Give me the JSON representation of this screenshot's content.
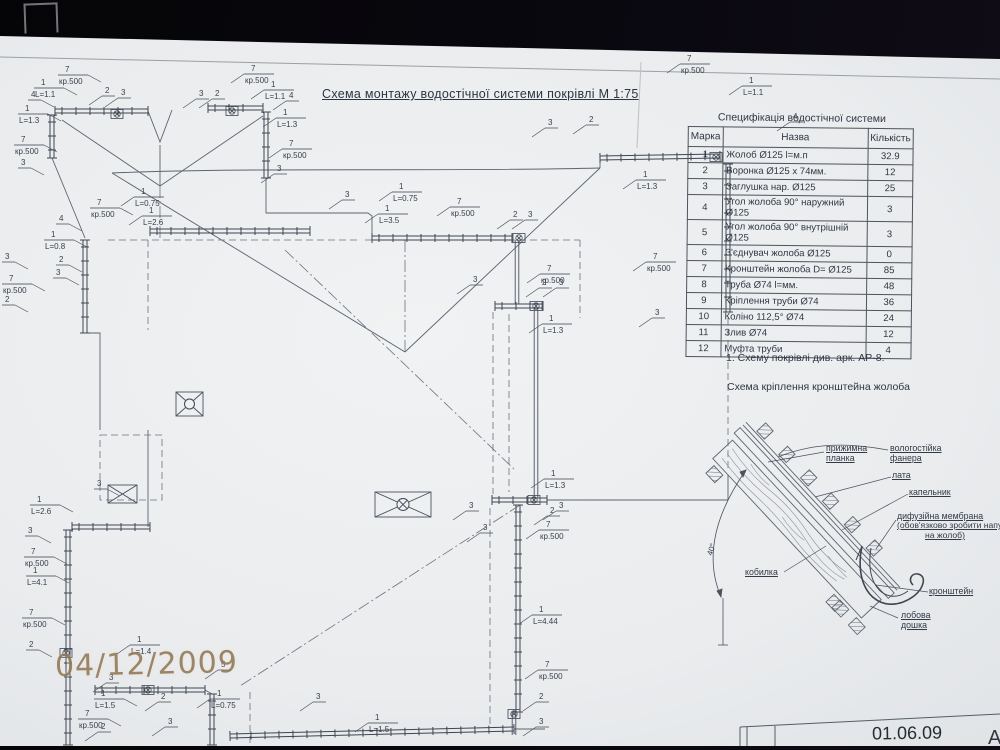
{
  "main_title": "Схема монтажу водостічної системи покрівлі М 1:75",
  "spec_table": {
    "title": "Специфікація водостічної системи",
    "columns": [
      "Марка",
      "Назва",
      "Кількість"
    ],
    "rows": [
      [
        "1",
        "Жолоб Ø125  l=м.п",
        "32.9"
      ],
      [
        "2",
        "Воронка Ø125 х 74мм.",
        "12"
      ],
      [
        "3",
        "Заглушка нар. Ø125",
        "25"
      ],
      [
        "4",
        "Угол жолоба 90° наружний  Ø125",
        "3"
      ],
      [
        "5",
        "Угол жолоба 90° внутрішній  Ø125",
        "3"
      ],
      [
        "6",
        "З'єднувач жолоба  Ø125",
        "0"
      ],
      [
        "7",
        "Кронштейн жолоба  D=  Ø125",
        "85"
      ],
      [
        "8",
        "Труба  Ø74  l=мм.",
        "48"
      ],
      [
        "9",
        "Кріплення труби  Ø74",
        "36"
      ],
      [
        "10",
        "Коліно 112,5°  Ø74",
        "24"
      ],
      [
        "11",
        "Злив  Ø74",
        "12"
      ],
      [
        "12",
        "Муфта труби",
        "4"
      ]
    ]
  },
  "note": "1.    Схему  покрівлі див. арк. АР-8.",
  "detail": {
    "title": "Схема кріплення кронштейна жолоба",
    "labels": {
      "plank": "прижимна планка",
      "plywood": "вологостійка фанера",
      "batten": "лата",
      "drip": "капельник",
      "membrane": "дифузійна мембрана",
      "membrane_note_1": "(обов'язково зробити напуск",
      "membrane_note_2": "на жолоб)",
      "bracket": "кронштейн",
      "fascia": "лобова дошка",
      "rafter": "кобилка",
      "angle": "40°"
    }
  },
  "plan": {
    "callouts": [
      [
        58,
        73,
        "7",
        "кр.500"
      ],
      [
        34,
        86,
        "1",
        "L=1.1"
      ],
      [
        28,
        98,
        "4",
        ""
      ],
      [
        18,
        112,
        "1",
        "L=1.3"
      ],
      [
        102,
        94,
        "2",
        ""
      ],
      [
        118,
        96,
        "3",
        ""
      ],
      [
        196,
        97,
        "3",
        ""
      ],
      [
        212,
        97,
        "2",
        ""
      ],
      [
        244,
        72,
        "7",
        "кр.500"
      ],
      [
        264,
        88,
        "1",
        "L=1.1"
      ],
      [
        286,
        99,
        "4",
        ""
      ],
      [
        276,
        116,
        "1",
        "L=1.3"
      ],
      [
        14,
        143,
        "7",
        "кр.500"
      ],
      [
        18,
        166,
        "3",
        ""
      ],
      [
        282,
        147,
        "7",
        "кр.500"
      ],
      [
        274,
        172,
        "3",
        ""
      ],
      [
        545,
        126,
        "3",
        ""
      ],
      [
        586,
        123,
        "2",
        ""
      ],
      [
        680,
        62,
        "7",
        "кр.500"
      ],
      [
        742,
        84,
        "1",
        "L=1.1"
      ],
      [
        790,
        120,
        "4",
        ""
      ],
      [
        636,
        178,
        "1",
        "L=1.3"
      ],
      [
        646,
        260,
        "7",
        "кр.500"
      ],
      [
        652,
        316,
        "3",
        ""
      ],
      [
        134,
        195,
        "1",
        "L=0.75"
      ],
      [
        142,
        214,
        "1",
        "L=2.6"
      ],
      [
        90,
        206,
        "7",
        "кр.500"
      ],
      [
        56,
        222,
        "4",
        ""
      ],
      [
        44,
        238,
        "1",
        "L=0.8"
      ],
      [
        56,
        263,
        "2",
        ""
      ],
      [
        53,
        276,
        "3",
        ""
      ],
      [
        2,
        260,
        "3",
        ""
      ],
      [
        2,
        282,
        "7",
        "кр.500"
      ],
      [
        2,
        303,
        "2",
        ""
      ],
      [
        342,
        198,
        "3",
        ""
      ],
      [
        392,
        190,
        "1",
        "L=0.75"
      ],
      [
        378,
        212,
        "1",
        "L=3.5"
      ],
      [
        450,
        205,
        "7",
        "кр.500"
      ],
      [
        510,
        218,
        "2",
        ""
      ],
      [
        525,
        218,
        "3",
        ""
      ],
      [
        470,
        283,
        "3",
        ""
      ],
      [
        540,
        272,
        "7",
        "кр.500"
      ],
      [
        539,
        286,
        "2",
        ""
      ],
      [
        556,
        286,
        "3",
        ""
      ],
      [
        542,
        322,
        "1",
        "L=1.3"
      ],
      [
        544,
        477,
        "1",
        "L=1.3"
      ],
      [
        466,
        509,
        "3",
        ""
      ],
      [
        547,
        514,
        "2",
        ""
      ],
      [
        556,
        509,
        "3",
        ""
      ],
      [
        539,
        528,
        "7",
        "кр.500"
      ],
      [
        480,
        531,
        "3",
        ""
      ],
      [
        94,
        487,
        "3",
        ""
      ],
      [
        30,
        503,
        "1",
        "L=2.6"
      ],
      [
        25,
        534,
        "3",
        ""
      ],
      [
        24,
        555,
        "7",
        "кр.500"
      ],
      [
        26,
        574,
        "1",
        "L=4.1"
      ],
      [
        22,
        616,
        "7",
        "кр.500"
      ],
      [
        26,
        648,
        "2",
        ""
      ],
      [
        130,
        643,
        "1",
        "L=1.4"
      ],
      [
        532,
        613,
        "1",
        "L=4.44"
      ],
      [
        538,
        668,
        "7",
        "кр.500"
      ],
      [
        536,
        700,
        "2",
        ""
      ],
      [
        536,
        725,
        "3",
        ""
      ],
      [
        106,
        681,
        "3",
        ""
      ],
      [
        94,
        697,
        "1",
        "L=1.5"
      ],
      [
        78,
        717,
        "7",
        "кр.500"
      ],
      [
        98,
        730,
        "2",
        ""
      ],
      [
        158,
        700,
        "2",
        ""
      ],
      [
        218,
        668,
        "5",
        ""
      ],
      [
        210,
        697,
        "1",
        "L=0.75"
      ],
      [
        165,
        725,
        "3",
        ""
      ],
      [
        313,
        700,
        "3",
        ""
      ],
      [
        368,
        721,
        "1",
        "L=1.5"
      ]
    ]
  },
  "stamps": {
    "camera_date": "04/12/2009",
    "titleblock_date": "01.06.09",
    "titleblock_letter": "А"
  }
}
